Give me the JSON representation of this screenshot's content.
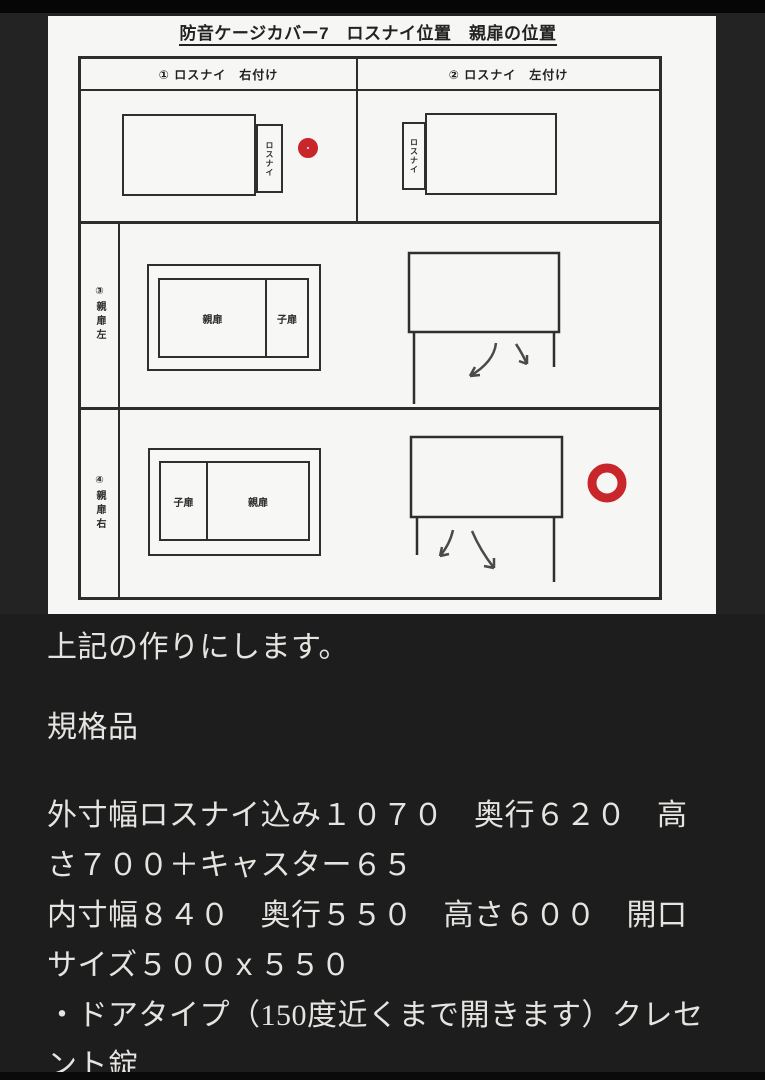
{
  "page": {
    "title": "防音ケージカバー7　ロスナイ位置　親扉の位置",
    "table": {
      "header_left": "① ロスナイ　右付け",
      "header_right": "② ロスナイ　左付け",
      "lossnay": "ロスナイ",
      "row2_label": "③親扉左",
      "row3_label": "④親扉右",
      "parent_door": "親扉",
      "child_door": "子扉"
    },
    "colors": {
      "mark_red": "#c9262b",
      "diagram_line": "#2d2d2d",
      "page_bg": "#f6f6f4",
      "dark_bg": "#1d1d1d"
    }
  },
  "notes": {
    "lines": [
      "上記の作りにします。",
      "規格品",
      "外寸幅ロスナイ込み１０７０　奥行６２０　高",
      "さ７００＋キャスター６５",
      "内寸幅８４０　奥行５５０　高さ６００　開口",
      "サイズ５００ｘ５５０",
      "・ドアタイプ（150度近くまで開きます）クレセ",
      "ント錠"
    ]
  }
}
